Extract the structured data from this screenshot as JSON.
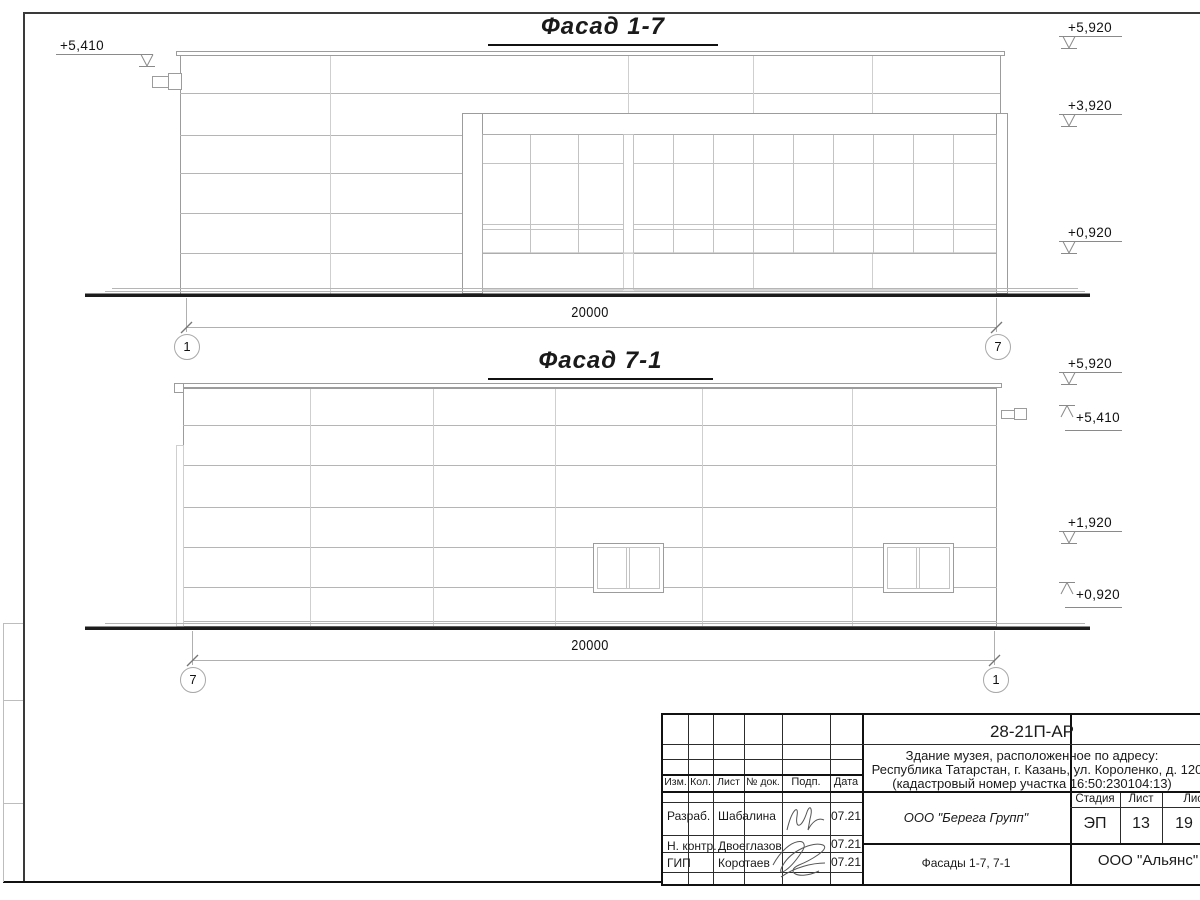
{
  "facade1": {
    "title": "Фасад 1-7",
    "dimension": "20000",
    "axis_left": "1",
    "axis_right": "7",
    "level_left": "+5,410",
    "levels_right": [
      "+5,920",
      "+3,920",
      "+0,920"
    ]
  },
  "facade2": {
    "title": "Фасад 7-1",
    "dimension": "20000",
    "axis_left": "7",
    "axis_right": "1",
    "levels_right": [
      "+5,920",
      "+5,410",
      "+1,920",
      "+0,920"
    ]
  },
  "title_block": {
    "doc_code": "28-21П-АР",
    "project_address_line1": "Здание музея, расположенное по адресу:",
    "project_address_line2": "Республика Татарстан, г. Казань, ул. Короленко, д. 120",
    "project_address_line3": "(кадастровый номер участка 16:50:230104:13)",
    "col_izm": "Изм.",
    "col_kol": "Кол.",
    "col_list": "Лист",
    "col_dok": "№ док.",
    "col_podp": "Подп.",
    "col_data": "Дата",
    "row_razrab_role": "Разраб.",
    "row_razrab_name": "Шабалина",
    "row_razrab_date": "07.21",
    "row_nkontr_role": "Н. контр.",
    "row_nkontr_name": "Двоеглазов",
    "row_nkontr_date": "07.21",
    "row_gip_role": "ГИП",
    "row_gip_name": "Коротаев",
    "row_gip_date": "07.21",
    "design_org": "ООО \"Берега Групп\"",
    "sheet_name": "Фасады 1-7, 7-1",
    "client_org": "ООО \"Альянс\"",
    "stage_label": "Стадия",
    "list_label": "Лист",
    "listov_label": "Листов",
    "stage_value": "ЭП",
    "list_value": "13",
    "listov_value": "19"
  },
  "colors": {
    "ground": "#1c1c1c",
    "outline": "#9c9c9c",
    "light_line": "#c4c4c4"
  }
}
